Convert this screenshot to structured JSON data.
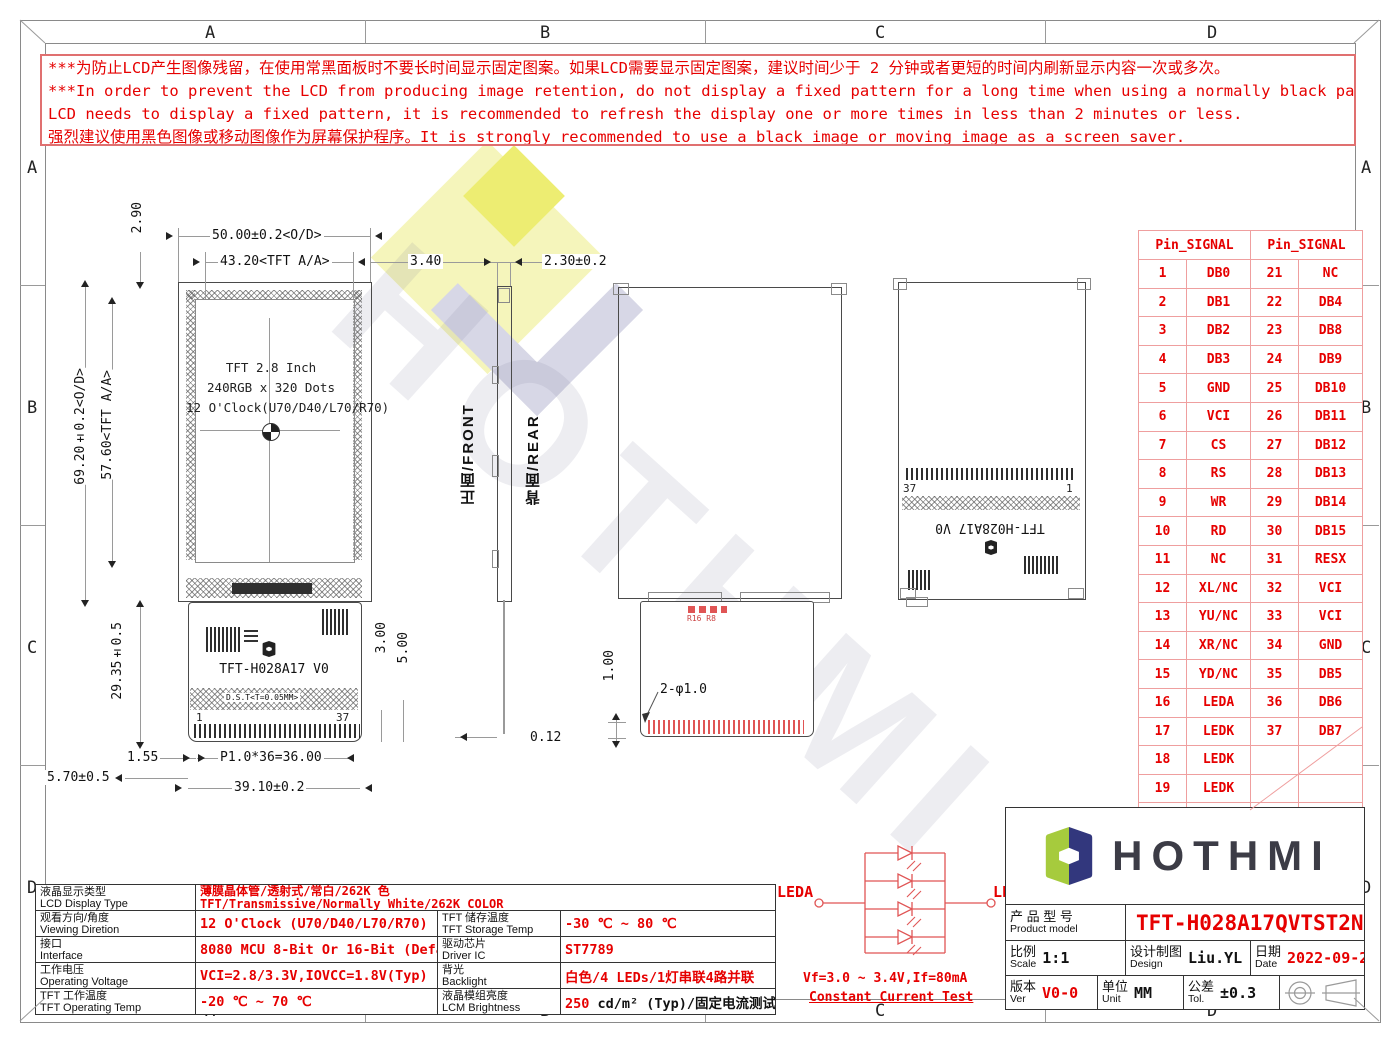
{
  "zones": [
    "A",
    "B",
    "C",
    "D"
  ],
  "warning": {
    "line1": "***为防止LCD产生图像残留，在使用常黑面板时不要长时间显示固定图案。如果LCD需要显示固定图案，建议时间少于 2 分钟或者更短的时间内刷新显示内容一次或多次。",
    "line2": "***In order to prevent the LCD from producing image retention, do not display a fixed pattern for a long time when using a normally black panel.If the",
    "line3": " LCD needs to display a fixed pattern, it is recommended to refresh the display one or more times in less than 2 minutes or less.",
    "line4": "强烈建议使用黑色图像或移动图像作为屏幕保护程序。It is strongly recommended to use a black image or moving image as a screen saver."
  },
  "logo": {
    "text": "HOTHMI"
  },
  "views": {
    "front": {
      "line1": "TFT 2.8 Inch",
      "line2": "240RGB x 320 Dots",
      "line3": "12 O'Clock(U70/D40/L70/R70)",
      "fpc_label": "TFT-H028A17 V0",
      "dst_label": "D.S.T<T=0.05MM>",
      "pin_first": "1",
      "pin_last": "37",
      "front_label": "正面/FRONT",
      "rear_label": "背面/REAR"
    },
    "rear_fpc": {
      "r_label": "R16 R8"
    },
    "rear": {
      "fpc_label": "TFT-H028A17 V0",
      "pin_left": "37",
      "pin_right": "1"
    }
  },
  "dims": {
    "t_290": "2.90",
    "od_w": "50.00±0.2<O/D>",
    "aa_w": "43.20<TFT A/A>",
    "gap_340": "3.40",
    "thk": "2.30±0.2",
    "aa_h": "57.60<TFT A/A>",
    "od_h": "69.20±0.2<O/D>",
    "fpc_h": "29.35±0.5",
    "d_300": "3.00",
    "d_500": "5.00",
    "d_155": "1.55",
    "pitch": "P1.0*36=36.00",
    "fpc_w": "39.10±0.2",
    "d_570": "5.70±0.5",
    "d_012": "0.12",
    "d_100": "1.00",
    "hole": "2-φ1.0"
  },
  "pin_table": {
    "header": "Pin_SIGNAL",
    "rows_left": [
      [
        "1",
        "DB0"
      ],
      [
        "2",
        "DB1"
      ],
      [
        "3",
        "DB2"
      ],
      [
        "4",
        "DB3"
      ],
      [
        "5",
        "GND"
      ],
      [
        "6",
        "VCI"
      ],
      [
        "7",
        "CS"
      ],
      [
        "8",
        "RS"
      ],
      [
        "9",
        "WR"
      ],
      [
        "10",
        "RD"
      ],
      [
        "11",
        "NC"
      ],
      [
        "12",
        "XL/NC"
      ],
      [
        "13",
        "YU/NC"
      ],
      [
        "14",
        "XR/NC"
      ],
      [
        "15",
        "YD/NC"
      ],
      [
        "16",
        "LEDA"
      ],
      [
        "17",
        "LEDK"
      ],
      [
        "18",
        "LEDK"
      ],
      [
        "19",
        "LEDK"
      ],
      [
        "20",
        "LEDK"
      ]
    ],
    "rows_right": [
      [
        "21",
        "NC"
      ],
      [
        "22",
        "DB4"
      ],
      [
        "23",
        "DB8"
      ],
      [
        "24",
        "DB9"
      ],
      [
        "25",
        "DB10"
      ],
      [
        "26",
        "DB11"
      ],
      [
        "27",
        "DB12"
      ],
      [
        "28",
        "DB13"
      ],
      [
        "29",
        "DB14"
      ],
      [
        "30",
        "DB15"
      ],
      [
        "31",
        "RESX"
      ],
      [
        "32",
        "VCI"
      ],
      [
        "33",
        "VCI"
      ],
      [
        "34",
        "GND"
      ],
      [
        "35",
        "DB5"
      ],
      [
        "36",
        "DB6"
      ],
      [
        "37",
        "DB7"
      ],
      [
        "",
        ""
      ],
      [
        "",
        ""
      ],
      [
        "",
        ""
      ]
    ]
  },
  "led_circuit": {
    "anode": "LEDA",
    "cathode": "LEDK",
    "spec": "Vf=3.0 ~ 3.4V,If=80mA",
    "note": "Constant Current Test"
  },
  "spec_table": {
    "rows": [
      [
        {
          "t": "label",
          "cn": "液晶显示类型",
          "en": "LCD Display Type"
        },
        {
          "t": "value2",
          "l1": "薄膜晶体管/透射式/常白/262K 色",
          "l2": "TFT/Transmissive/Normally White/262K COLOR",
          "span": 3
        }
      ],
      [
        {
          "t": "label",
          "cn": "观看方向/角度",
          "en": "Viewing Diretion"
        },
        {
          "t": "value",
          "v": "12 O'Clock (U70/D40/L70/R70)"
        },
        {
          "t": "label",
          "cn": "TFT 储存温度",
          "en": "TFT Storage Temp"
        },
        {
          "t": "value",
          "v": "-30 ℃ ~ 80 ℃"
        }
      ],
      [
        {
          "t": "label",
          "cn": "接口",
          "en": "Interface"
        },
        {
          "t": "value",
          "v": "8080 MCU 8-Bit Or 16-Bit (Default)"
        },
        {
          "t": "label",
          "cn": "驱动芯片",
          "en": "Driver IC"
        },
        {
          "t": "value",
          "v": "ST7789"
        }
      ],
      [
        {
          "t": "label",
          "cn": "工作电压",
          "en": "Operating Voltage"
        },
        {
          "t": "value",
          "v": "VCI=2.8/3.3V,IOVCC=1.8V(Typ)"
        },
        {
          "t": "label",
          "cn": "背光",
          "en": "Backlight"
        },
        {
          "t": "value",
          "v": "白色/4 LEDs/1灯串联4路并联"
        }
      ],
      [
        {
          "t": "label",
          "cn": "TFT 工作温度",
          "en": "TFT Operating Temp"
        },
        {
          "t": "value",
          "v": "-20 ℃ ~ 70 ℃"
        },
        {
          "t": "label",
          "cn": "液晶模组亮度",
          "en": "LCM Brightness"
        },
        {
          "t": "mixed",
          "red": "250",
          "black": " cd/m² (Typ)/固定电流测试"
        }
      ]
    ]
  },
  "title_block": {
    "product_cn": "产 品 型 号",
    "product_en": "Product model",
    "product_value": "TFT-H028A17QVTST2N37",
    "scale_cn": "比例",
    "scale_en": "Scale",
    "scale_value": "1:1",
    "design_cn": "设计制图",
    "design_en": "Design",
    "design_value": "Liu.YL",
    "date_cn": "日期",
    "date_en": "Date",
    "date_value": "2022-09-27",
    "ver_cn": "版本",
    "ver_en": "Ver",
    "ver_value": "V0-0",
    "unit_cn": "单位",
    "unit_en": "Unit",
    "unit_value": "MM",
    "tol_cn": "公差",
    "tol_en": "Tol.",
    "tol_value": "±0.3"
  },
  "colors": {
    "red": "#e60000",
    "pin_border": "#ef9f9f",
    "logo_green": "#a6cb3d",
    "logo_navy": "#32377d"
  }
}
